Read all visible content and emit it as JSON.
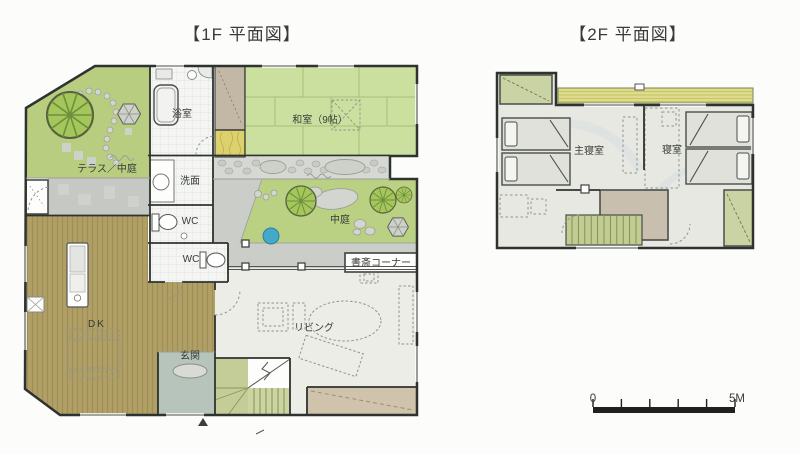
{
  "titles": {
    "floor1": "【1F 平面図】",
    "floor2": "【2F 平面図】"
  },
  "floor1": {
    "bath": "浴室",
    "japanese_room": "和室（9帖）",
    "terrace_courtyard": "テラス／中庭",
    "washroom": "洗面",
    "wc_upper": "WC",
    "wc_lower": "WC",
    "courtyard": "中庭",
    "study_corner": "書斎コーナー",
    "dining_kitchen": "DK",
    "entrance": "玄関",
    "living": "リビング"
  },
  "floor2": {
    "master_bedroom": "主寝室",
    "bedroom": "寝室"
  },
  "scale_bar": {
    "start": "0",
    "end": "5M"
  },
  "colors": {
    "garden_green": "#b9cd80",
    "courtyard_green": "#bad184",
    "tatami_green": "#cbdf9f",
    "tree_green": "#a5c65a",
    "wood_floor": "#b1a066",
    "terrace_gray": "#c6c9c3",
    "stone_path": "#d6d9d3",
    "living_floor": "#ecede7",
    "entrance_floor": "#b7c4bc",
    "stair_green": "#c4cd98",
    "slope_tan": "#cfc3ab",
    "closet_tan": "#c3b7a6",
    "tokonoma_yellow": "#ddd06e",
    "bedroom_floor": "#e7e8e2",
    "closet_green_2f": "#c9d3a3",
    "balcony_yellow": "#dddc8b",
    "pond_blue": "#45a8c8",
    "wall": "#2f332f"
  }
}
